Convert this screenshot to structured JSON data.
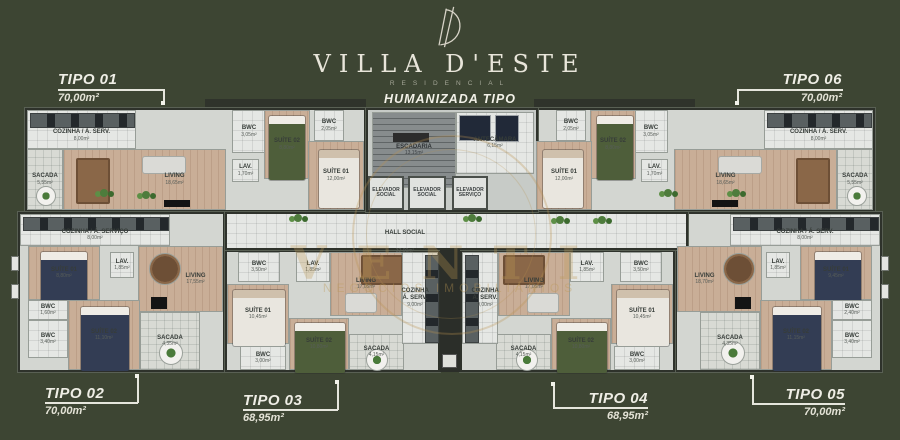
{
  "header": {
    "monogram": "D",
    "brand": "VILLA D'ESTE",
    "brand_sub": "RESIDENCIAL",
    "subtitle": "HUMANIZADA TIPO"
  },
  "watermark": {
    "line1": "VENTI",
    "line2": "NEGÓCIOS IMOBILIÁRIOS"
  },
  "colors": {
    "background": "#3d4533",
    "gold": "#b9924f",
    "line": "#e6e6dd",
    "green_bed": "#4e5e3a"
  },
  "units": {
    "tipo01": {
      "label": "TIPO 01",
      "area": "70,00m²"
    },
    "tipo02": {
      "label": "TIPO 02",
      "area": "70,00m²"
    },
    "tipo03": {
      "label": "TIPO 03",
      "area": "68,95m²"
    },
    "tipo04": {
      "label": "TIPO 04",
      "area": "68,95m²"
    },
    "tipo05": {
      "label": "TIPO 05",
      "area": "70,00m²"
    },
    "tipo06": {
      "label": "TIPO 06",
      "area": "70,00m²"
    }
  },
  "core": {
    "escadaria": {
      "name": "ESCADARIA",
      "area": "13,15m²"
    },
    "antecamara": {
      "name": "ANTECÂMARA",
      "area": "6,15m²"
    },
    "elevador1": {
      "name": "ELEVADOR SOCIAL"
    },
    "elevador2": {
      "name": "ELEVADOR SOCIAL"
    },
    "elevador3": {
      "name": "ELEVADOR SERVIÇO"
    },
    "hall": {
      "name": "HALL SOCIAL",
      "area": "32,00m²"
    }
  },
  "apartments": {
    "tipo01": {
      "rooms": [
        {
          "name": "COZINHA / Á. SERV.",
          "area": "8,00m²"
        },
        {
          "name": "SACADA",
          "area": "5,55m²"
        },
        {
          "name": "LIVING",
          "area": "18,65m²"
        },
        {
          "name": "BWC",
          "area": "3,05m²"
        },
        {
          "name": "LAV.",
          "area": "1,70m²"
        },
        {
          "name": "SUÍTE 02",
          "area": "8,80m²"
        },
        {
          "name": "BWC",
          "area": "2,05m²"
        },
        {
          "name": "SUÍTE 01",
          "area": "12,00m²"
        }
      ]
    },
    "tipo06": {
      "rooms": [
        {
          "name": "COZINHA / Á. SERV.",
          "area": "8,00m²"
        },
        {
          "name": "SACADA",
          "area": "5,55m²"
        },
        {
          "name": "LIVING",
          "area": "18,65m²"
        },
        {
          "name": "BWC",
          "area": "3,05m²"
        },
        {
          "name": "LAV.",
          "area": "1,70m²"
        },
        {
          "name": "SUÍTE 02",
          "area": "8,80m²"
        },
        {
          "name": "BWC",
          "area": "2,05m²"
        },
        {
          "name": "SUÍTE 01",
          "area": "12,00m²"
        }
      ]
    },
    "tipo02": {
      "rooms": [
        {
          "name": "COZINHA / Á. SERVIÇO",
          "area": "8,00m²"
        },
        {
          "name": "SUÍTE 01",
          "area": "8,80m²"
        },
        {
          "name": "LAV.",
          "area": "1,85m²"
        },
        {
          "name": "LIVING",
          "area": "17,55m²"
        },
        {
          "name": "BWC",
          "area": "1,60m²"
        },
        {
          "name": "BWC",
          "area": "3,40m²"
        },
        {
          "name": "SUÍTE 02",
          "area": "11,10m²"
        },
        {
          "name": "SACADA",
          "area": "4,35m²"
        }
      ]
    },
    "tipo05": {
      "rooms": [
        {
          "name": "COZINHA / Á. SERV.",
          "area": "8,00m²"
        },
        {
          "name": "SUÍTE 01",
          "area": "9,45m²"
        },
        {
          "name": "LAV.",
          "area": "1,85m²"
        },
        {
          "name": "LIVING",
          "area": "18,70m²"
        },
        {
          "name": "BWC",
          "area": "2,40m²"
        },
        {
          "name": "BWC",
          "area": "3,40m²"
        },
        {
          "name": "SUÍTE 02",
          "area": "11,15m²"
        },
        {
          "name": "SACADA",
          "area": "4,35m²"
        }
      ]
    },
    "tipo03": {
      "rooms": [
        {
          "name": "BWC",
          "area": "3,50m²"
        },
        {
          "name": "LAV.",
          "area": "1,85m²"
        },
        {
          "name": "SUÍTE 01",
          "area": "10,45m²"
        },
        {
          "name": "BWC",
          "area": "3,00m²"
        },
        {
          "name": "SUÍTE 02",
          "area": "10,80m²"
        },
        {
          "name": "SACADA",
          "area": "4,15m²"
        },
        {
          "name": "LIVING",
          "area": "17,05m²"
        },
        {
          "name": "COZINHA Á. SERV.",
          "area": "9,00m²"
        }
      ]
    },
    "tipo04": {
      "rooms": [
        {
          "name": "BWC",
          "area": "3,50m²"
        },
        {
          "name": "LAV.",
          "area": "1,85m²"
        },
        {
          "name": "SUÍTE 01",
          "area": "10,45m²"
        },
        {
          "name": "BWC",
          "area": "3,00m²"
        },
        {
          "name": "SUÍTE 02",
          "area": "10,80m²"
        },
        {
          "name": "SACADA",
          "area": "4,15m²"
        },
        {
          "name": "LIVING",
          "area": "17,05m²"
        },
        {
          "name": "COZINHA Á. SERV.",
          "area": "9,00m²"
        }
      ]
    }
  }
}
